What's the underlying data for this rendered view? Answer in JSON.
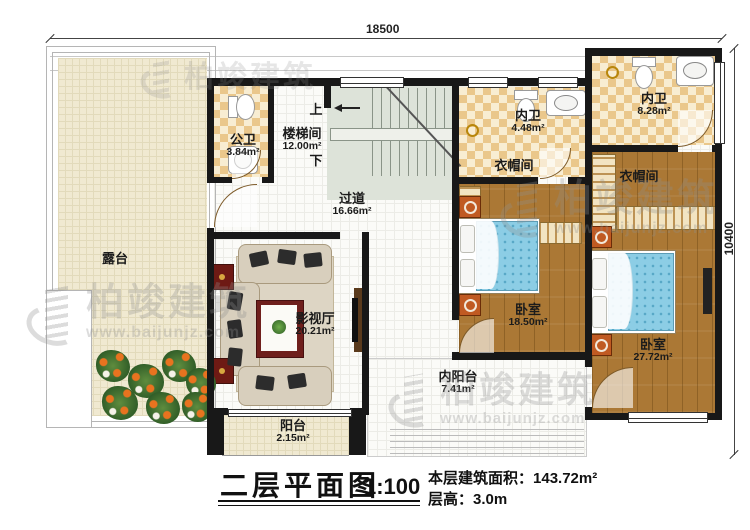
{
  "plan": {
    "title": "二层平面图",
    "scale": "1:100",
    "info": {
      "area_label": "本层建筑面积：",
      "area_value": "143.72m²",
      "height_label": "层高：",
      "height_value": "3.0m"
    },
    "dimensions": {
      "width": "18500",
      "depth": "10400"
    },
    "stairs": {
      "up": "上",
      "down": "下"
    },
    "rooms": {
      "terrace": {
        "name": "露台"
      },
      "public_bath": {
        "name": "公卫",
        "area": "3.84m²"
      },
      "stairwell": {
        "name": "楼梯间",
        "area": "12.00m²"
      },
      "hallway": {
        "name": "过道",
        "area": "16.66m²"
      },
      "ensuite_small": {
        "name": "内卫",
        "area": "4.48m²"
      },
      "ensuite_large": {
        "name": "内卫",
        "area": "8.28m²"
      },
      "closet_left": {
        "name": "衣帽间"
      },
      "closet_right": {
        "name": "衣帽间"
      },
      "theater": {
        "name": "影视厅",
        "area": "20.21m²"
      },
      "bedroom_left": {
        "name": "卧室",
        "area": "18.50m²"
      },
      "bedroom_right": {
        "name": "卧室",
        "area": "27.72m²"
      },
      "inner_balcony": {
        "name": "内阳台",
        "area": "7.41m²"
      },
      "balcony": {
        "name": "阳台",
        "area": "2.15m²"
      }
    },
    "watermark": {
      "brand": "柏竣建筑",
      "site": "www.baijunjz.com"
    },
    "colors": {
      "wall": "#181818",
      "wood_floor": "#ab7835",
      "tile_tan": "#eac78b",
      "terrace": "#f0e9d1",
      "bed_blue": "#8ccde5",
      "accent_orange": "#c05a22"
    }
  }
}
